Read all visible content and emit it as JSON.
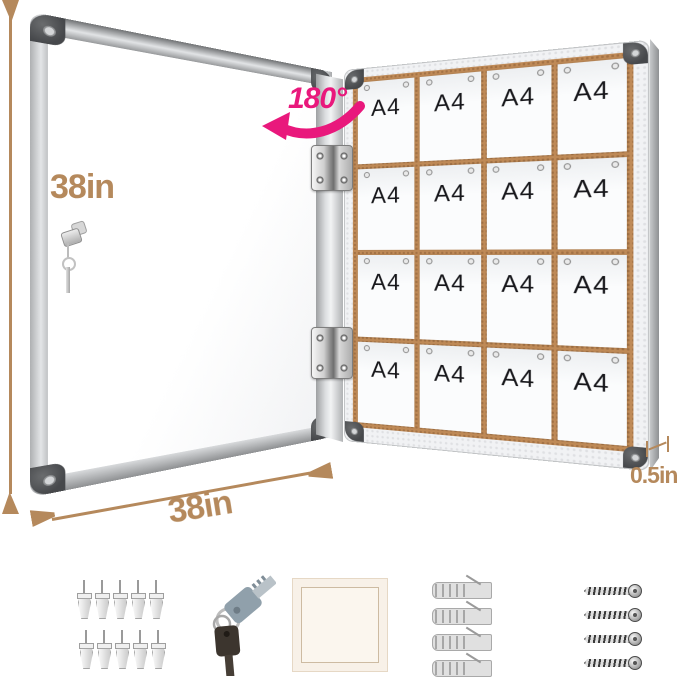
{
  "dimensions": {
    "height_label": "38in",
    "width_label": "38in",
    "depth_label": "0.5in",
    "swing_angle_label": "180°"
  },
  "board": {
    "rows": 4,
    "cols": 4,
    "sheet_label": "A4",
    "hinge_count": 2
  },
  "accessories": {
    "push_pins": {
      "count": 10,
      "per_row": 5
    },
    "keys": {
      "count": 2
    },
    "wall_anchors": {
      "count": 4
    },
    "screws": {
      "count": 4
    }
  },
  "colors": {
    "dimension": "#b5895c",
    "accent": "#e9187c",
    "cork": "#bf8a57",
    "frame": "#c9cbcd",
    "cap": "#46484b"
  }
}
